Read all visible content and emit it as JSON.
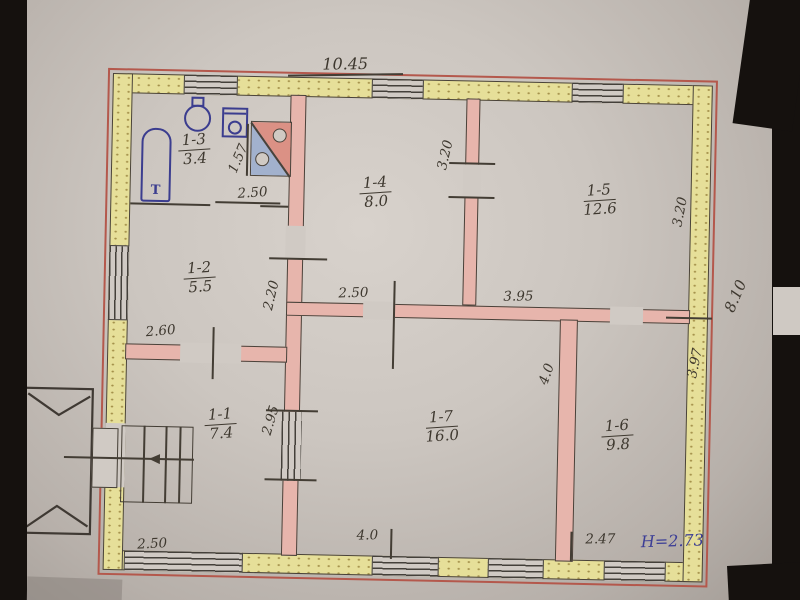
{
  "plan": {
    "rooms": [
      {
        "id": "1-1",
        "area": "7.4"
      },
      {
        "id": "1-2",
        "area": "5.5"
      },
      {
        "id": "1-3",
        "area": "3.4"
      },
      {
        "id": "1-4",
        "area": "8.0"
      },
      {
        "id": "1-5",
        "area": "12.6"
      },
      {
        "id": "1-6",
        "area": "9.8"
      },
      {
        "id": "1-7",
        "area": "16.0"
      }
    ],
    "dims": {
      "top_total": "10.45",
      "right_total": "8.10",
      "bathroom_width": "2.50",
      "stove_width": "1.57",
      "room4_depth": "3.20",
      "room5_depth": "3.20",
      "hall_width": "3.95",
      "corridor_width": "2.50",
      "room2_depth": "2.20",
      "room2_width": "2.60",
      "room1_depth": "2.95",
      "room7_depth": "4.0",
      "room6_depth": "3.97",
      "bottom_left": "2.50",
      "bottom_middle": "4.0",
      "bottom_right": "2.47",
      "ceiling_height": "Н=2.73"
    },
    "fixtures": {
      "tub_label": "Т"
    },
    "colors": {
      "exterior_wall": "#e6df99",
      "interior_wall": "#e7b5ac",
      "outline_red": "#b4584c",
      "pencil": "#433d34",
      "blue_ink": "#3c3e96",
      "paper": "#ccc6c0"
    }
  }
}
